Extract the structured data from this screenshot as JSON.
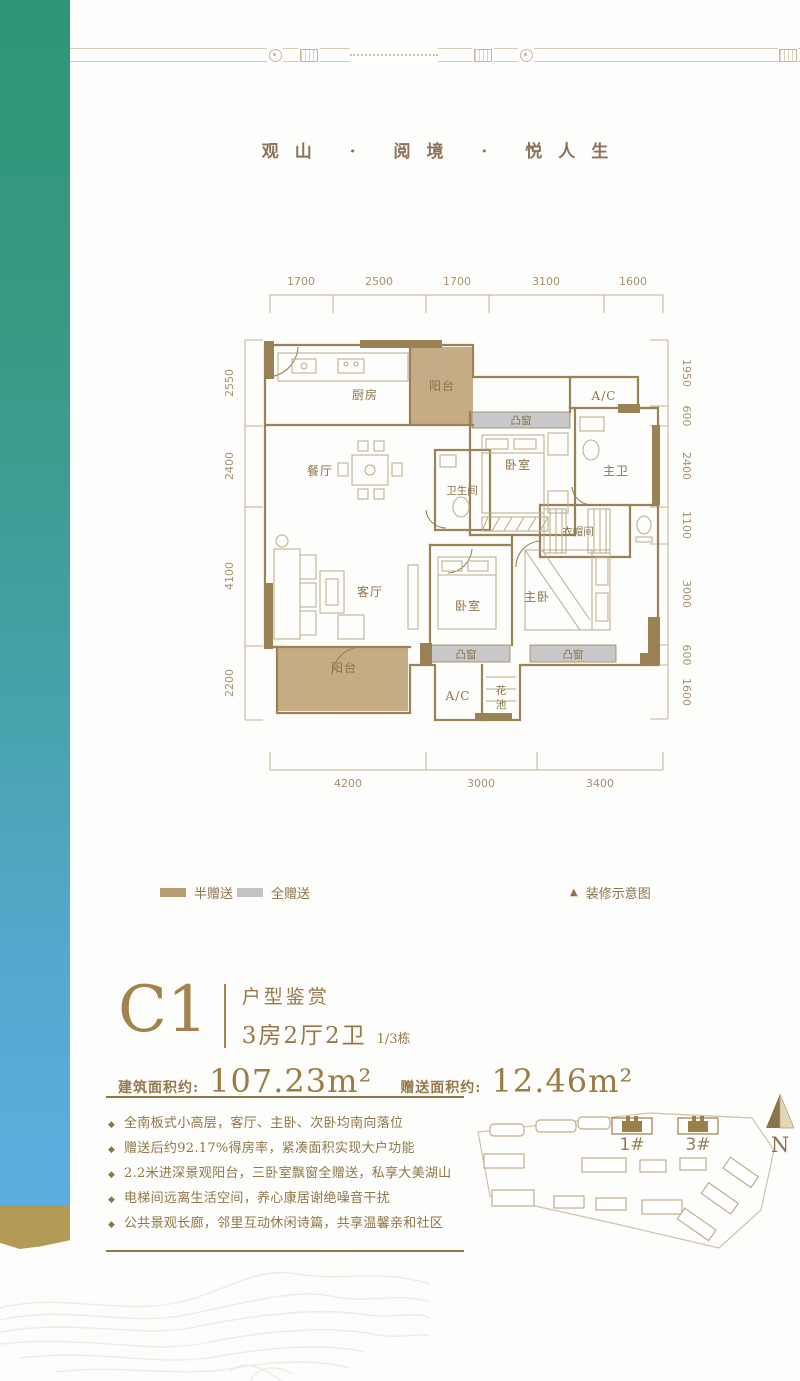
{
  "page": {
    "title": "观山 · 阅境 · 悦人生"
  },
  "floor_plan": {
    "dims_top": [
      "1700",
      "2500",
      "1700",
      "3100",
      "1600"
    ],
    "dims_left": [
      "2550",
      "2400",
      "4100",
      "2200"
    ],
    "dims_right": [
      "1950",
      "600",
      "2400",
      "1100",
      "3000",
      "600",
      "1600"
    ],
    "dims_bottom": [
      "4200",
      "3000",
      "3400"
    ],
    "rooms": {
      "kitchen": "厨房",
      "balcony_top": "阳台",
      "ac_top": "A/C",
      "bay_top": "凸窗",
      "bedroom_top": "卧室",
      "master_bath": "主卫",
      "bathroom": "卫生间",
      "dining": "餐厅",
      "closet": "衣帽间",
      "living": "客厅",
      "bedroom_bottom": "卧室",
      "master_bedroom": "主卧",
      "bay_bottom_left": "凸窗",
      "bay_bottom_right": "凸窗",
      "balcony_bottom": "阳台",
      "ac_bottom": "A/C",
      "flower_top": "花",
      "flower_bottom": "池"
    }
  },
  "legend": {
    "half_gift": "半赠送",
    "full_gift": "全赠送",
    "note_icon": "▲",
    "note": "装修示意图"
  },
  "unit": {
    "code": "C1",
    "subtitle": "户型鉴赏",
    "layout": "3房2厅2卫",
    "building": "1/3栋",
    "area_label_1": "建筑面积约:",
    "area_value_1": "107.23m²",
    "area_label_2": "赠送面积约:",
    "area_value_2": "12.46m²"
  },
  "features_bullet": "◆",
  "features": [
    "全南板式小高层，客厅、主卧、次卧均南向落位",
    "赠送后约92.17%得房率，紧凑面积实现大户功能",
    "2.2米进深景观阳台，三卧室飘窗全赠送，私享大美湖山",
    "电梯间远离生活空间，养心康居谢绝噪音干扰",
    "公共景观长廊，邻里互动休闲诗篇，共享温馨亲和社区"
  ],
  "sitemap": {
    "building_1": "1#",
    "building_3": "3#",
    "compass": "N"
  },
  "colors": {
    "gold": "#9a8254",
    "tan_fill": "#c6ac85",
    "gray_fill": "#c8c8cb",
    "band_green": "#2e9677",
    "band_blue": "#5cade0",
    "band_gold_tip": "#b09a56"
  }
}
